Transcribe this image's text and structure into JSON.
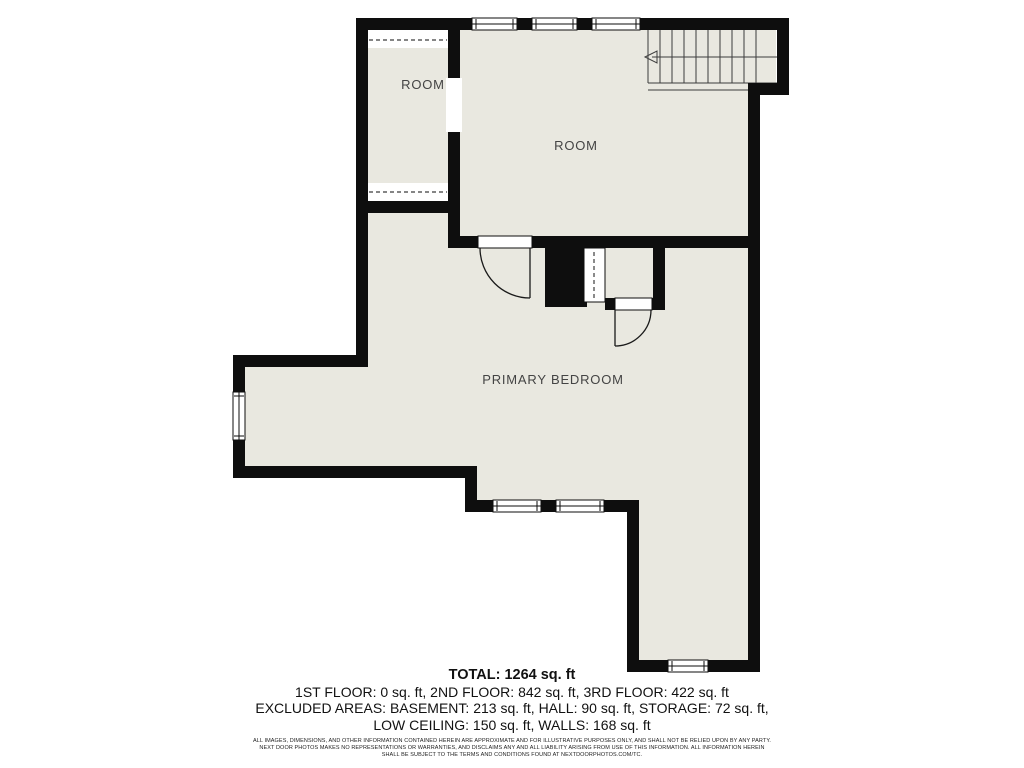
{
  "colors": {
    "floor": "#e9e8e0",
    "wall": "#0e0e0e",
    "line": "#3c3c3c",
    "label": "#444444",
    "background": "#ffffff"
  },
  "plan": {
    "rooms": [
      {
        "label": "ROOM"
      },
      {
        "label": "ROOM"
      },
      {
        "label": "PRIMARY BEDROOM"
      }
    ],
    "features": [
      "staircase-up-arrow",
      "low-ceiling-dashed-zones",
      "windows",
      "door-swings"
    ]
  },
  "summary": {
    "total": "TOTAL: 1264 sq. ft",
    "floors": "1ST FLOOR: 0 sq. ft, 2ND FLOOR: 842 sq. ft, 3RD FLOOR: 422 sq. ft",
    "excluded_1": "EXCLUDED AREAS: BASEMENT: 213 sq. ft, HALL: 90 sq. ft, STORAGE: 72 sq. ft,",
    "excluded_2": "LOW CEILING: 150 sq. ft, WALLS: 168 sq. ft"
  },
  "disclaimer": {
    "line1": "ALL IMAGES, DIMENSIONS, AND OTHER INFORMATION CONTAINED HEREIN ARE APPROXIMATE AND FOR ILLUSTRATIVE PURPOSES ONLY, AND SHALL NOT BE RELIED UPON BY ANY PARTY.",
    "line2": "NEXT DOOR PHOTOS MAKES NO REPRESENTATIONS OR WARRANTIES, AND DISCLAIMS ANY AND ALL LIABILITY ARISING FROM USE OF THIS INFORMATION. ALL INFORMATION HEREIN",
    "line3": "SHALL BE SUBJECT TO THE TERMS AND CONDITIONS FOUND AT NEXTDOORPHOTOS.COM/TC."
  }
}
